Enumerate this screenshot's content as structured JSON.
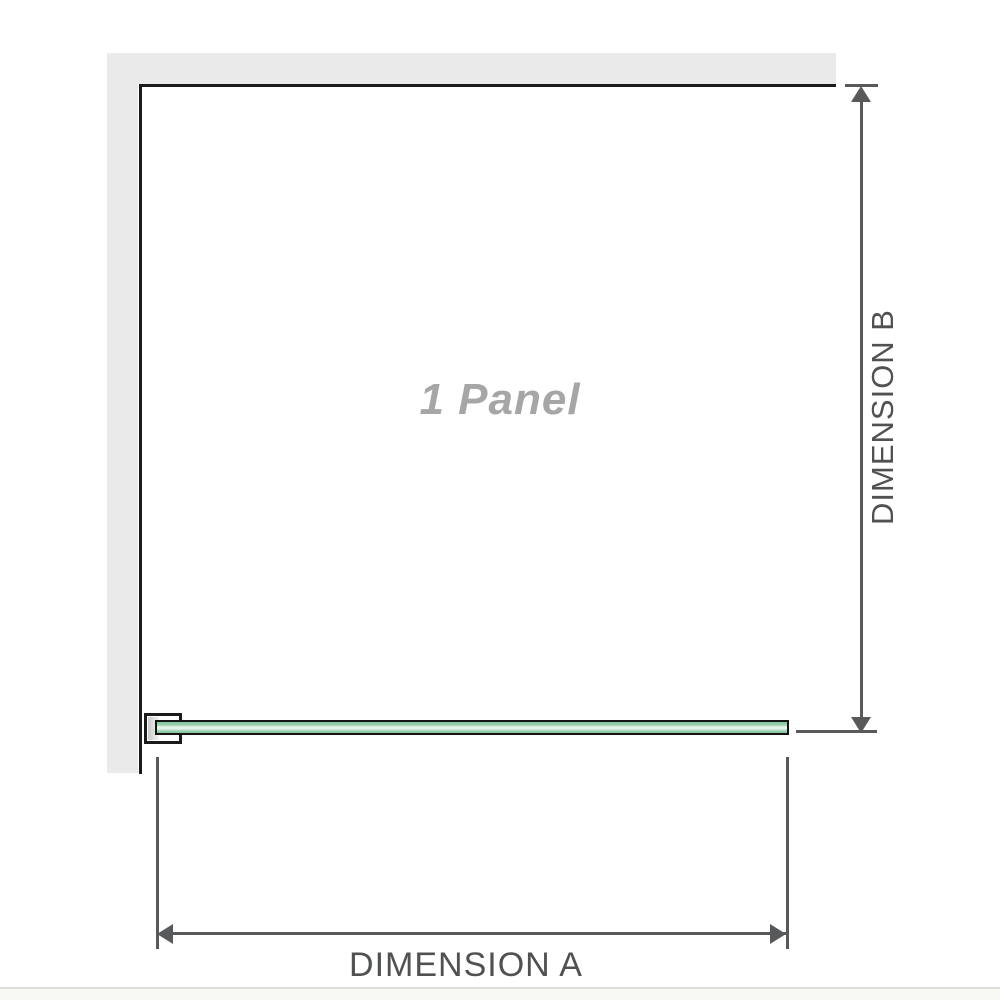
{
  "labels": {
    "panel": "1 Panel",
    "dimension_a": "DIMENSION A",
    "dimension_b": "DIMENSION B"
  },
  "icons": {
    "dimension_b_arrows": "double-headed-vertical-arrow-icon",
    "dimension_a_arrows": "double-headed-horizontal-arrow-icon"
  },
  "colors": {
    "wall": "#eaeaea",
    "wall-edge": "#1b1b1b",
    "dimension": "#58595b",
    "label-text": "#4f5153",
    "panel-label": "#a6a6a6",
    "glass-dark": "#7fc39a",
    "glass-mid": "#9ed2b2",
    "glass-light": "#e6f5eb",
    "bracket-block": "#c9c9c9",
    "footer-line": "#dcdcd8",
    "footer-bg": "#f8f8f5"
  }
}
